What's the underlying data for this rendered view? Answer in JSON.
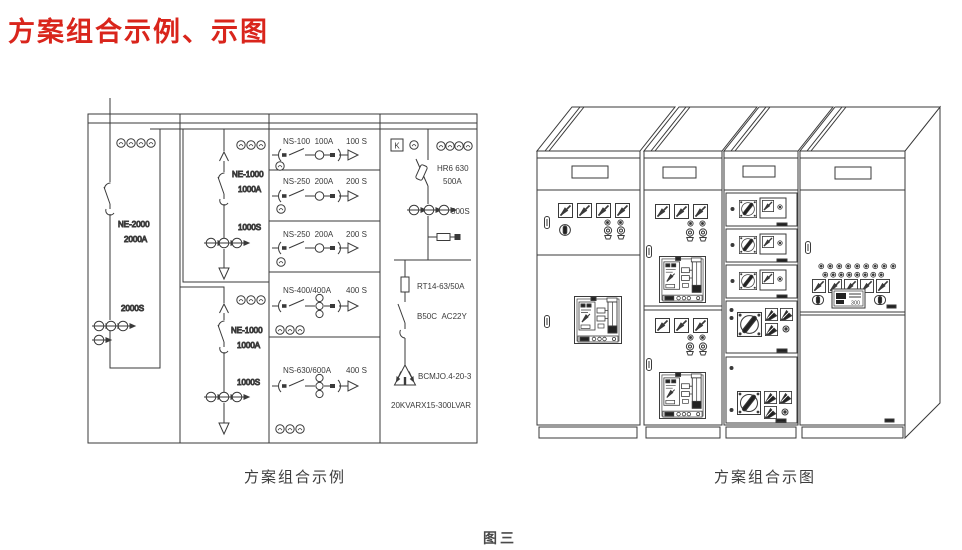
{
  "title": "方案组合示例、示图",
  "captions": {
    "schematic": "方案组合示例",
    "cabinets": "方案组合示图",
    "figure": "图三"
  },
  "colors": {
    "title_red": "#d9251c",
    "line": "#3a3a3a"
  },
  "schematic": {
    "incomer_main": {
      "model": "NE-2000",
      "rating": "2000A",
      "ct": "2000S"
    },
    "incomer_upper": {
      "model": "NE-1000",
      "rating": "1000A",
      "ct": "1000S"
    },
    "incomer_lower": {
      "model": "NE-1000",
      "rating": "1000A",
      "ct": "1000S"
    },
    "feeders": [
      {
        "model": "NS-100  100A",
        "ct": "100 S"
      },
      {
        "model": "NS-250  200A",
        "ct": "200 S"
      },
      {
        "model": "NS-250  200A",
        "ct": "200 S"
      },
      {
        "model": "NS-400/400A",
        "ct": "400 S"
      },
      {
        "model": "NS-630/600A",
        "ct": "400 S"
      }
    ],
    "capacitor_branch": {
      "k_label": "K",
      "switch_model": "HR6 630",
      "switch_rating": "500A",
      "ct": "500S",
      "fuse": "RT14-63/50A",
      "contactor": "B50C  AC22Y",
      "capacitor_model": "BCMJO.4-20-3",
      "bank_rating": "20KVARX15-300LVAR"
    }
  },
  "cabinets": {
    "meter_display": "300"
  }
}
